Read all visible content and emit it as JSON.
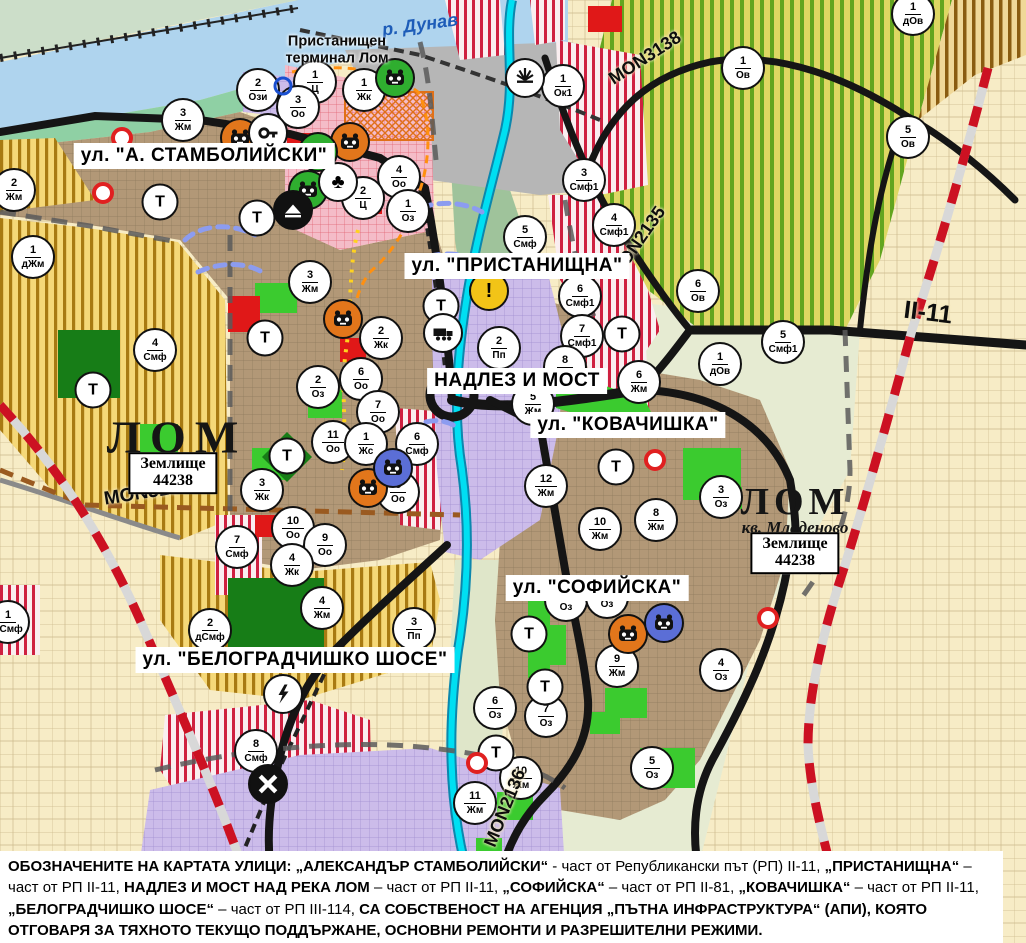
{
  "labels": {
    "river": "р. Дунав",
    "terminal": "Пристанищен\nтерминал Лом",
    "city_main": "ЛОМ",
    "city_quarter": "ЛОМ",
    "quarter_sub": "кв. Младеново",
    "plot": "Землище\n44238",
    "t_marker": "Т"
  },
  "street_labels": [
    {
      "text": "ул. \"А. СТАМБОЛИЙСКИ\"",
      "x": 204,
      "y": 156
    },
    {
      "text": "ул. \"ПРИСТАНИЩНА\"",
      "x": 517,
      "y": 266
    },
    {
      "text": "НАДЛЕЗ И МОСТ",
      "x": 517,
      "y": 381
    },
    {
      "text": "ул. \"КОВАЧИШКА\"",
      "x": 628,
      "y": 425
    },
    {
      "text": "ул. \"СОФИЙСКА\"",
      "x": 597,
      "y": 588
    },
    {
      "text": "ул. \"БЕЛОГРАДЧИШКО ШОСЕ\"",
      "x": 295,
      "y": 660
    }
  ],
  "road_labels": [
    {
      "text": "MON3139",
      "x": 147,
      "y": 493,
      "rot": -9,
      "size": 19
    },
    {
      "text": "MON3138",
      "x": 645,
      "y": 58,
      "rot": -33,
      "size": 18
    },
    {
      "text": "MON2135",
      "x": 638,
      "y": 242,
      "rot": -55,
      "size": 18
    },
    {
      "text": "MON2136",
      "x": 505,
      "y": 808,
      "rot": -68,
      "size": 18
    },
    {
      "text": "II-11",
      "x": 928,
      "y": 313,
      "rot": 7,
      "size": 25
    }
  ],
  "zone_markers": [
    {
      "n": "2",
      "c": "Ози",
      "x": 258,
      "y": 90
    },
    {
      "n": "1",
      "c": "Ц",
      "x": 315,
      "y": 82
    },
    {
      "n": "1",
      "c": "Жк",
      "x": 364,
      "y": 90
    },
    {
      "n": "3",
      "c": "Оо",
      "x": 298,
      "y": 107
    },
    {
      "n": "3",
      "c": "Жм",
      "x": 183,
      "y": 120
    },
    {
      "n": "2",
      "c": "Жм",
      "x": 14,
      "y": 190
    },
    {
      "n": "1",
      "c": "дЖм",
      "x": 33,
      "y": 257
    },
    {
      "n": "4",
      "c": "Оо",
      "x": 399,
      "y": 177
    },
    {
      "n": "2",
      "c": "Ц",
      "x": 363,
      "y": 198
    },
    {
      "n": "1",
      "c": "Оз",
      "x": 408,
      "y": 211
    },
    {
      "n": "1",
      "c": "Ок1",
      "x": 563,
      "y": 86
    },
    {
      "n": "1",
      "c": "дОв",
      "x": 913,
      "y": 14
    },
    {
      "n": "1",
      "c": "Ов",
      "x": 743,
      "y": 68
    },
    {
      "n": "5",
      "c": "Ов",
      "x": 908,
      "y": 137
    },
    {
      "n": "3",
      "c": "Смф1",
      "x": 584,
      "y": 180
    },
    {
      "n": "4",
      "c": "Смф1",
      "x": 614,
      "y": 225
    },
    {
      "n": "5",
      "c": "Смф",
      "x": 525,
      "y": 237
    },
    {
      "n": "6",
      "c": "Ов",
      "x": 698,
      "y": 291
    },
    {
      "n": "5",
      "c": "Смф1",
      "x": 783,
      "y": 342
    },
    {
      "n": "1",
      "c": "дОв",
      "x": 720,
      "y": 364
    },
    {
      "n": "6",
      "c": "Смф1",
      "x": 580,
      "y": 296
    },
    {
      "n": "7",
      "c": "Смф1",
      "x": 582,
      "y": 336
    },
    {
      "n": "2",
      "c": "Пп",
      "x": 499,
      "y": 348
    },
    {
      "n": "3",
      "c": "Жм",
      "x": 310,
      "y": 282
    },
    {
      "n": "2",
      "c": "Жк",
      "x": 381,
      "y": 338
    },
    {
      "n": "2",
      "c": "Оз",
      "x": 318,
      "y": 387
    },
    {
      "n": "6",
      "c": "Оо",
      "x": 361,
      "y": 379
    },
    {
      "n": "7",
      "c": "Оо",
      "x": 378,
      "y": 412
    },
    {
      "n": "11",
      "c": "Оо",
      "x": 333,
      "y": 442
    },
    {
      "n": "1",
      "c": "Жс",
      "x": 366,
      "y": 444
    },
    {
      "n": "6",
      "c": "Смф",
      "x": 417,
      "y": 444
    },
    {
      "n": "8",
      "c": "Оо",
      "x": 398,
      "y": 492
    },
    {
      "n": "3",
      "c": "Жк",
      "x": 262,
      "y": 490
    },
    {
      "n": "10",
      "c": "Оо",
      "x": 293,
      "y": 528
    },
    {
      "n": "9",
      "c": "Оо",
      "x": 325,
      "y": 545
    },
    {
      "n": "7",
      "c": "Смф",
      "x": 237,
      "y": 547
    },
    {
      "n": "4",
      "c": "Жк",
      "x": 292,
      "y": 565
    },
    {
      "n": "4",
      "c": "Смф",
      "x": 155,
      "y": 350
    },
    {
      "n": "4",
      "c": "Жм",
      "x": 322,
      "y": 608
    },
    {
      "n": "2",
      "c": "дСмф",
      "x": 210,
      "y": 630
    },
    {
      "n": "3",
      "c": "Пп",
      "x": 414,
      "y": 629
    },
    {
      "n": "8",
      "c": "Смф",
      "x": 256,
      "y": 751
    },
    {
      "n": "8",
      "c": "Жм",
      "x": 565,
      "y": 367
    },
    {
      "n": "6",
      "c": "Жм",
      "x": 639,
      "y": 382
    },
    {
      "n": "5",
      "c": "Жм",
      "x": 533,
      "y": 404
    },
    {
      "n": "12",
      "c": "Жм",
      "x": 546,
      "y": 486
    },
    {
      "n": "10",
      "c": "Жм",
      "x": 600,
      "y": 529
    },
    {
      "n": "8",
      "c": "Жм",
      "x": 656,
      "y": 520
    },
    {
      "n": "3",
      "c": "Оз",
      "x": 721,
      "y": 497
    },
    {
      "n": "9",
      "c": "Жм",
      "x": 617,
      "y": 666
    },
    {
      "n": "4",
      "c": "Оз",
      "x": 721,
      "y": 670
    },
    {
      "n": "6",
      "c": "Оз",
      "x": 495,
      "y": 708
    },
    {
      "n": "7",
      "c": "Оз",
      "x": 546,
      "y": 716
    },
    {
      "n": "5",
      "c": "Оз",
      "x": 652,
      "y": 768
    },
    {
      "n": "10",
      "c": "Жм",
      "x": 521,
      "y": 778
    },
    {
      "n": "11",
      "c": "Жм",
      "x": 475,
      "y": 803
    },
    {
      "n": "1",
      "c": "дСмф",
      "x": 8,
      "y": 622
    },
    {
      "n": "8",
      "c": "Оз",
      "x": 566,
      "y": 600
    },
    {
      "n": "2",
      "c": "Оз",
      "x": 607,
      "y": 597
    }
  ],
  "t_markers": [
    [
      160,
      202
    ],
    [
      257,
      218
    ],
    [
      265,
      338
    ],
    [
      93,
      390
    ],
    [
      287,
      456
    ],
    [
      441,
      306
    ],
    [
      622,
      334
    ],
    [
      616,
      467
    ],
    [
      529,
      634
    ],
    [
      545,
      687
    ],
    [
      496,
      753
    ]
  ],
  "icons": [
    {
      "t": "mask",
      "bg": "orange",
      "x": 240,
      "y": 138
    },
    {
      "t": "mask",
      "bg": "orange",
      "x": 350,
      "y": 142
    },
    {
      "t": "mask",
      "bg": "orange",
      "x": 343,
      "y": 319
    },
    {
      "t": "mask",
      "bg": "orange",
      "x": 368,
      "y": 488
    },
    {
      "t": "mask",
      "bg": "orange",
      "x": 628,
      "y": 634
    },
    {
      "t": "mask",
      "bg": "green",
      "x": 395,
      "y": 78
    },
    {
      "t": "mask",
      "bg": "green",
      "x": 318,
      "y": 152
    },
    {
      "t": "mask",
      "bg": "green",
      "x": 308,
      "y": 190
    },
    {
      "t": "mask",
      "bg": "blue",
      "x": 393,
      "y": 468
    },
    {
      "t": "mask",
      "bg": "blue",
      "x": 664,
      "y": 623
    },
    {
      "t": "key",
      "x": 268,
      "y": 133
    },
    {
      "t": "trefoil",
      "x": 338,
      "y": 182
    },
    {
      "t": "mountain",
      "x": 293,
      "y": 210
    },
    {
      "t": "fan",
      "x": 525,
      "y": 78
    },
    {
      "t": "warning",
      "x": 489,
      "y": 291
    },
    {
      "t": "truck",
      "x": 443,
      "y": 333
    },
    {
      "t": "lightning",
      "x": 283,
      "y": 694
    },
    {
      "t": "railx",
      "x": 268,
      "y": 784
    },
    {
      "t": "reddot",
      "x": 122,
      "y": 138
    },
    {
      "t": "reddot",
      "x": 103,
      "y": 193
    },
    {
      "t": "reddot",
      "x": 655,
      "y": 460
    },
    {
      "t": "reddot",
      "x": 477,
      "y": 763
    },
    {
      "t": "reddot",
      "x": 768,
      "y": 618
    },
    {
      "t": "bluering",
      "x": 283,
      "y": 86
    }
  ],
  "icon_colors": {
    "orange": "#e2761b",
    "green": "#2fae2f",
    "blue": "#5b6ed6",
    "warning": "#f2c417"
  },
  "footer": {
    "segments": [
      {
        "b": true,
        "t": "ОБОЗНАЧЕНИТЕ НА КАРТАТА УЛИЦИ: „АЛЕКСАНДЪР СТАМБОЛИЙСКИ“"
      },
      {
        "b": false,
        "t": " - част от Републикански път (РП) II-11, "
      },
      {
        "b": true,
        "t": "„ПРИСТАНИЩНА“"
      },
      {
        "b": false,
        "t": " – част от РП II-11, "
      },
      {
        "b": true,
        "t": "НАДЛЕЗ И МОСТ НАД РЕКА ЛОМ"
      },
      {
        "b": false,
        "t": " – част от РП II-11, "
      },
      {
        "b": true,
        "t": "„СОФИЙСКА“"
      },
      {
        "b": false,
        "t": " – част от РП II-81, "
      },
      {
        "b": true,
        "t": "„КОВАЧИШКА“"
      },
      {
        "b": false,
        "t": " – част от РП II-11, "
      },
      {
        "b": true,
        "t": "„БЕЛОГРАДЧИШКО ШОСЕ“"
      },
      {
        "b": false,
        "t": " – част от РП III-114, "
      },
      {
        "b": true,
        "t": "СА СОБСТВЕНОСТ НА АГЕНЦИЯ „ПЪТНА ИНФРАСТРУКТУРА“ (АПИ), КОЯТО ОТГОВАРЯ ЗА ТЯХНОТО ТЕКУЩО ПОДДЪРЖАНЕ, ОСНОВНИ РЕМОНТИ И РАЗРЕШИТЕЛНИ РЕЖИМИ."
      }
    ]
  }
}
